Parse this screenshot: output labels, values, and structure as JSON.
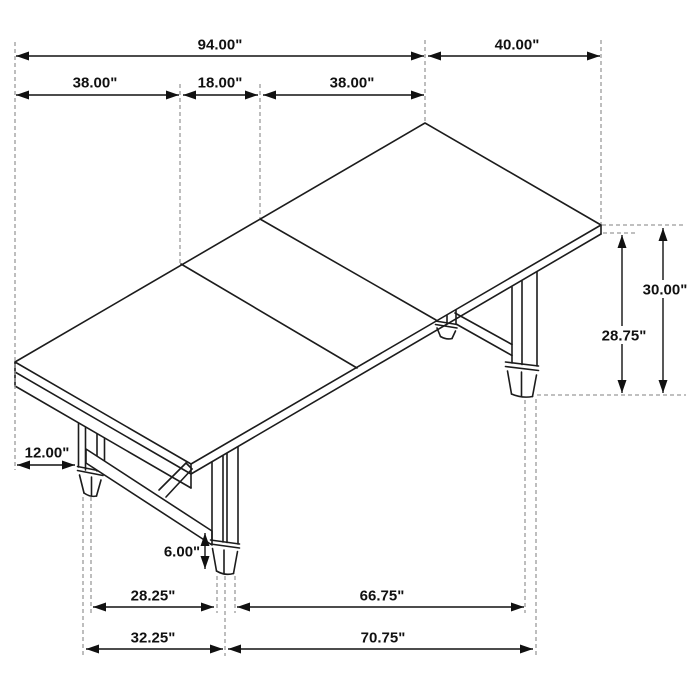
{
  "drawing": {
    "subject": "dining-table-isometric-dimension-drawing",
    "units": "inches"
  },
  "colors": {
    "background": "#ffffff",
    "artwork_line": "#1c1c1c",
    "dimension_line": "#111111",
    "extension_line": "#9b9b9b",
    "label_text": "#111111"
  },
  "dimensions": [
    {
      "id": "total-length",
      "label": "94.00\"",
      "orientation": "h",
      "x1": 16,
      "x2": 424,
      "y": 56,
      "lx": 220,
      "ly": 44,
      "bg": false
    },
    {
      "id": "end-width",
      "label": "40.00\"",
      "orientation": "h",
      "x1": 428,
      "x2": 600,
      "y": 56,
      "lx": 517,
      "ly": 44,
      "bg": false
    },
    {
      "id": "left-leaf-length",
      "label": "38.00\"",
      "orientation": "h",
      "x1": 16,
      "x2": 179,
      "y": 95,
      "lx": 95,
      "ly": 82,
      "bg": false
    },
    {
      "id": "center-leaf-length",
      "label": "18.00\"",
      "orientation": "h",
      "x1": 183,
      "x2": 258,
      "y": 95,
      "lx": 220,
      "ly": 82,
      "bg": false
    },
    {
      "id": "right-leaf-length",
      "label": "38.00\"",
      "orientation": "h",
      "x1": 263,
      "x2": 424,
      "y": 95,
      "lx": 352,
      "ly": 82,
      "bg": false
    },
    {
      "id": "top-overhang",
      "label": "12.00\"",
      "orientation": "h",
      "x1": 17,
      "x2": 75,
      "y": 465,
      "lx": 47,
      "ly": 452,
      "bg": false
    },
    {
      "id": "apron-clearance",
      "label": "28.75\"",
      "orientation": "v",
      "x": 622,
      "y1": 235,
      "y2": 393,
      "lx": 624,
      "ly": 335,
      "bg": true
    },
    {
      "id": "table-height",
      "label": "30.00\"",
      "orientation": "v",
      "x": 663,
      "y1": 228,
      "y2": 393,
      "lx": 665,
      "ly": 289,
      "bg": true
    },
    {
      "id": "stretcher-clearance",
      "label": "6.00\"",
      "orientation": "v",
      "x": 205,
      "y1": 533,
      "y2": 569,
      "lx": 182,
      "ly": 551,
      "bg": false
    },
    {
      "id": "trestle-span-inner",
      "label": "28.25\"",
      "orientation": "h",
      "x1": 93,
      "x2": 214,
      "y": 607,
      "lx": 153,
      "ly": 595,
      "bg": false
    },
    {
      "id": "leg-span-inner",
      "label": "66.75\"",
      "orientation": "h",
      "x1": 237,
      "x2": 524,
      "y": 607,
      "lx": 382,
      "ly": 595,
      "bg": false
    },
    {
      "id": "trestle-span-outer",
      "label": "32.25\"",
      "orientation": "h",
      "x1": 86,
      "x2": 223,
      "y": 649,
      "lx": 153,
      "ly": 637,
      "bg": false
    },
    {
      "id": "leg-span-outer",
      "label": "70.75\"",
      "orientation": "h",
      "x1": 228,
      "x2": 533,
      "y": 649,
      "lx": 383,
      "ly": 637,
      "bg": false
    }
  ],
  "extension_lines": {
    "vertical": [
      [
        15,
        42,
        470
      ],
      [
        180,
        84,
        263
      ],
      [
        260,
        84,
        218
      ],
      [
        425,
        40,
        122
      ],
      [
        601,
        40,
        224
      ],
      [
        83,
        497,
        656
      ],
      [
        91,
        497,
        613
      ],
      [
        217,
        576,
        613
      ],
      [
        225,
        576,
        656
      ],
      [
        235,
        576,
        613
      ],
      [
        525,
        400,
        613
      ],
      [
        536,
        399,
        656
      ]
    ],
    "horizontal": [
      [
        225,
        602,
        686
      ],
      [
        233,
        603,
        638
      ],
      [
        395,
        537,
        686
      ]
    ]
  }
}
